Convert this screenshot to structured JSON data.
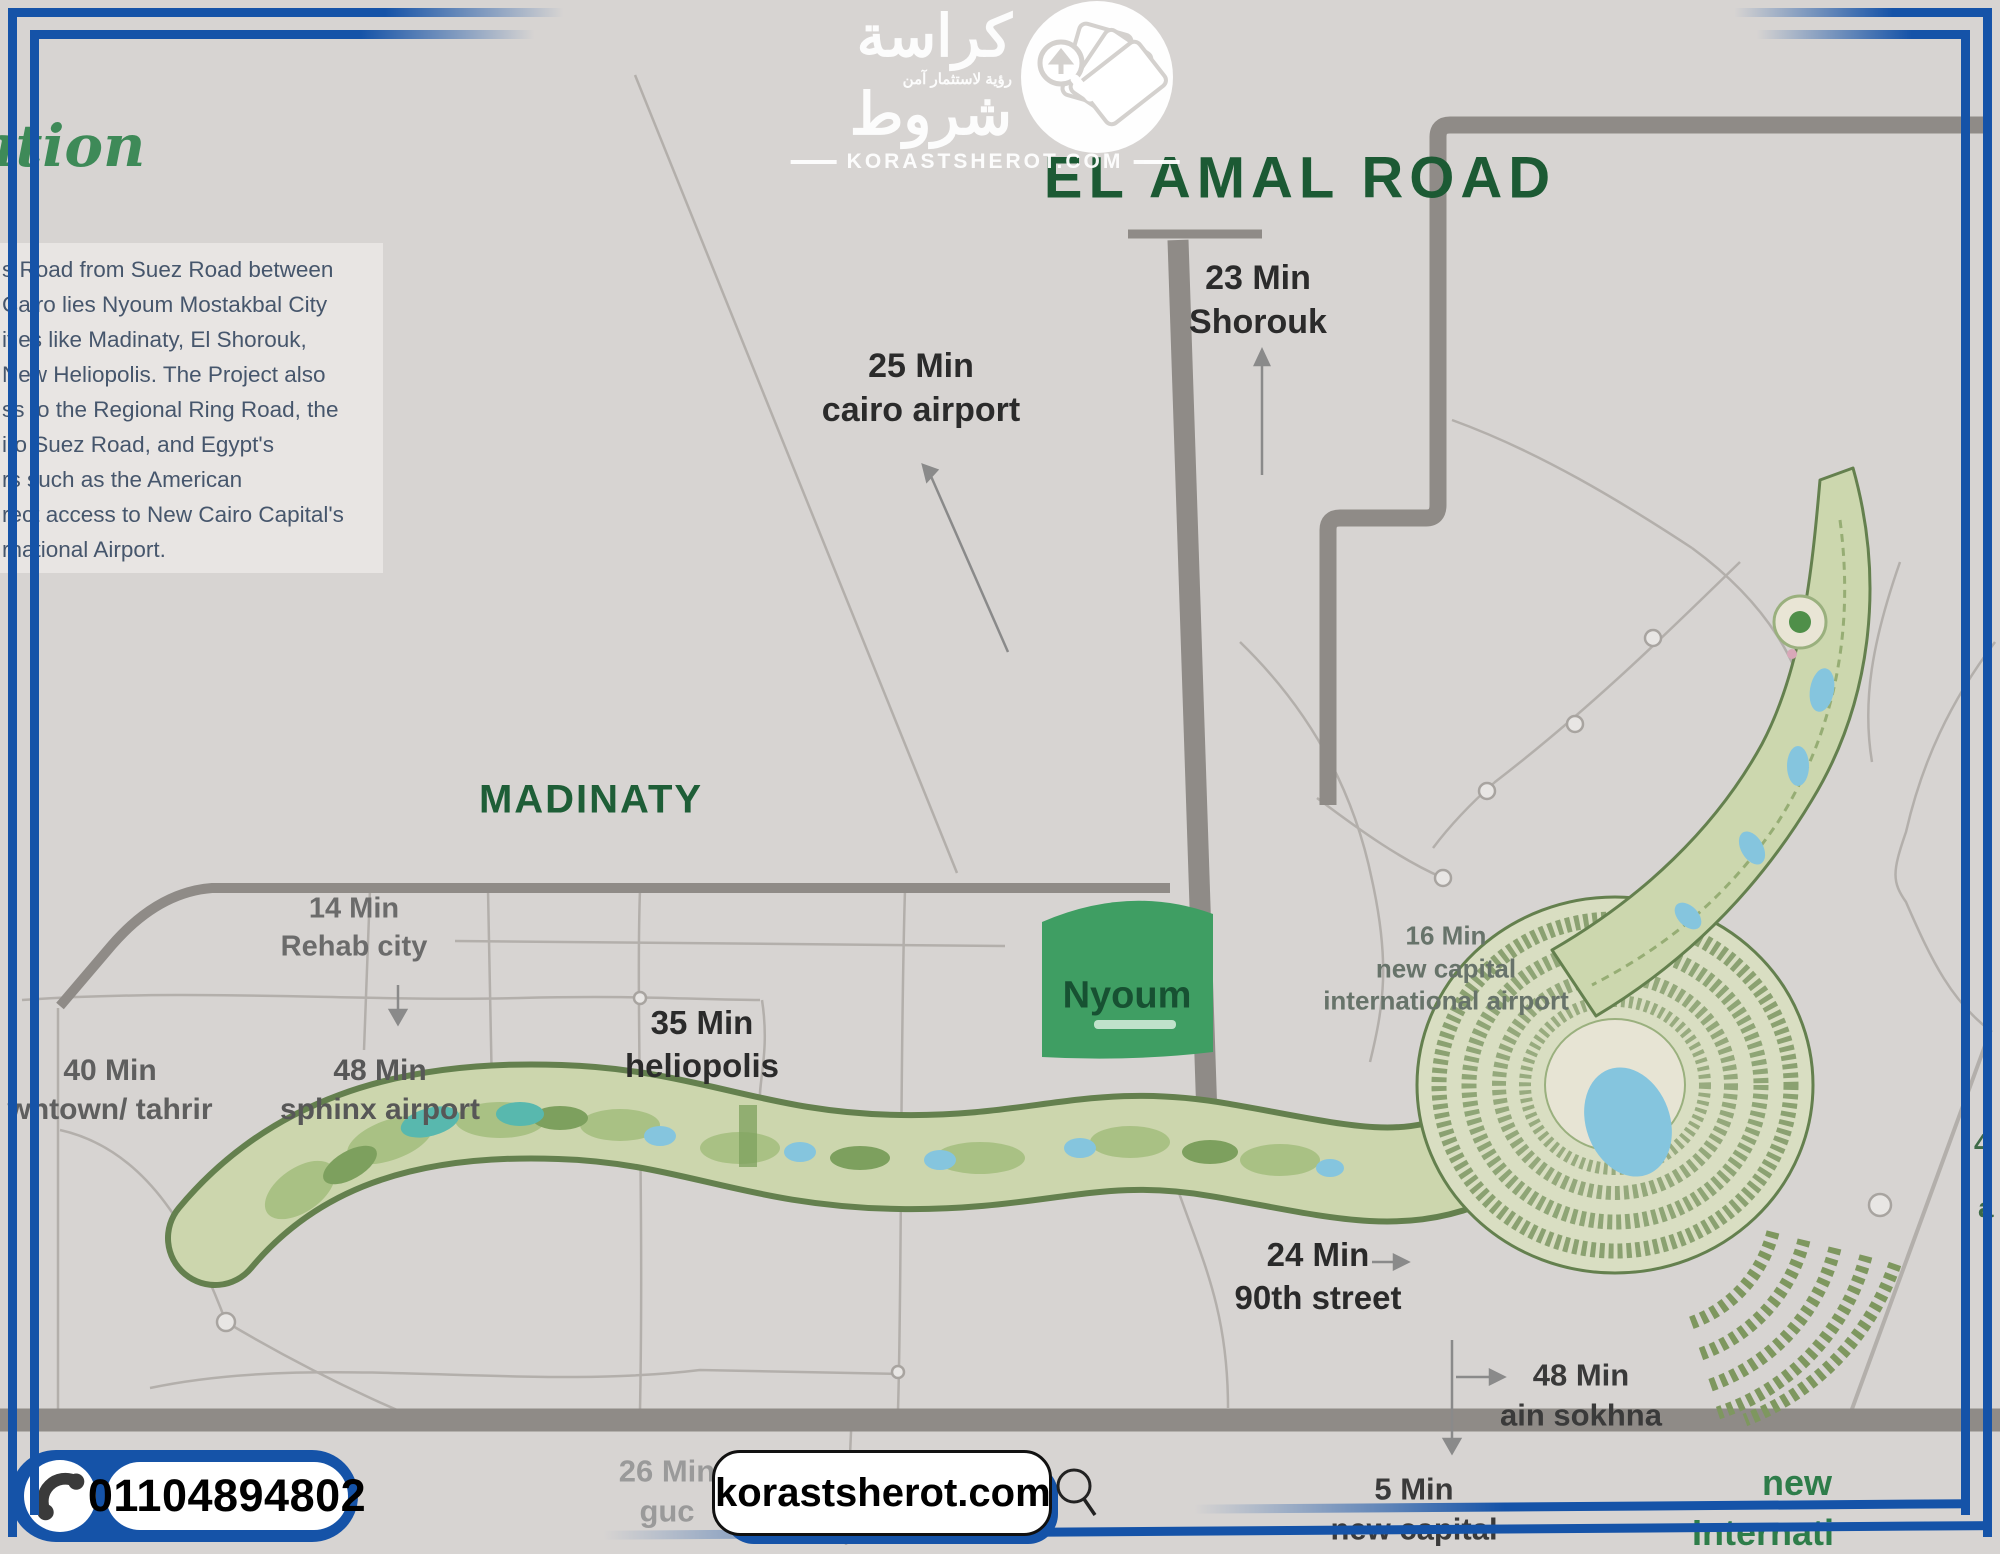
{
  "frame": {
    "accent_blue": "#1553a8"
  },
  "logo": {
    "arabic_title": "كراسة",
    "arabic_tagline": "رؤية لاستثمار آمن",
    "arabic_word": "شروط",
    "site_line": "KORASTSHEROT.COM"
  },
  "intro": {
    "script_fragment": "ation",
    "lines": [
      "s Road from Suez Road between",
      "Cairo lies Nyoum Mostakbal City",
      "ities like Madinaty, El Shorouk,",
      "New Heliopolis. The Project also",
      "ss to the Regional Ring Road, the",
      "iro Suez Road, and Egypt's",
      "rs such as the American",
      "rect access to New Cairo Capital's",
      "rnational Airport."
    ]
  },
  "map": {
    "road_title": "EL AMAL ROAD",
    "city_label": "MADINATY",
    "project_label": "Nyoum",
    "annotations": [
      {
        "time": "25 Min",
        "place": "cairo airport"
      },
      {
        "time": "23 Min",
        "place": "Shorouk"
      },
      {
        "time": "14 Min",
        "place": "Rehab city"
      },
      {
        "time": "35 Min",
        "place": "heliopolis"
      },
      {
        "time": "40 Min",
        "place": "wntown/ tahrir"
      },
      {
        "time": "48 Min",
        "place": "sphinx airport"
      },
      {
        "time": "16 Min",
        "place": "new capital international airport"
      },
      {
        "time": "24 Min",
        "place": "90th street"
      },
      {
        "time": "48 Min",
        "place": "ain sokhna"
      },
      {
        "time": "5 Min",
        "place": "new capital"
      },
      {
        "time": "26 Min",
        "place": "guc"
      }
    ],
    "edge_labels": {
      "right_top": "new",
      "right_bottom": "Internati",
      "frag_a": "4",
      "frag_b": "a"
    }
  },
  "footer": {
    "phone": "01104894802",
    "site": "korastsherot.com"
  },
  "colors": {
    "background": "#d7d4d2",
    "road_gray": "#8f8b87",
    "title_green": "#1c5a34",
    "nyoum_green": "#3f9e63",
    "accent_blue": "#1553a8"
  }
}
